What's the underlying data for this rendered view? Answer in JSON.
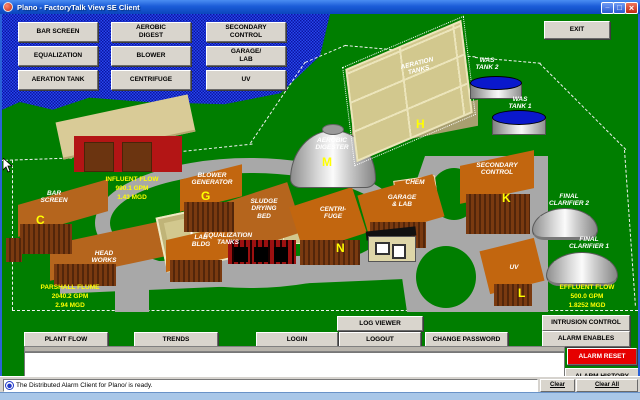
{
  "window": {
    "title": "Plano - FactoryTalk View SE Client"
  },
  "nav": {
    "buttons": [
      "BAR SCREEN",
      "AEROBIC\nDIGEST",
      "SECONDARY\nCONTROL",
      "EQUALIZATION",
      "BLOWER",
      "GARAGE/\nLAB",
      "AERATION TANK",
      "CENTRIFUGE",
      "UV"
    ],
    "exit": "EXIT"
  },
  "map": {
    "buildings": {
      "bar_screen": "BAR\nSCREEN",
      "head_works": "HEAD\nWORKS",
      "equalization": "EQUALIZATION\nTANKS",
      "blower_generator": "BLOWER\nGENERATOR",
      "lab_bldg": "LAB\nBLDG",
      "sludge": "SLUDGE\nDRYING\nBED",
      "centrifuge": "CENTRI-\nFUGE",
      "garage": "GARAGE\n& LAB",
      "chem": "CHEM",
      "secondary": "SECONDARY\nCONTROL",
      "uv": "UV",
      "aeration": "AERATION\nTANKS",
      "aerobic": "AEROBIC\nDIGESTER",
      "was2": "WAS\nTANK 2",
      "was1": "WAS\nTANK 1",
      "fc2": "FINAL\nCLARIFIER 2",
      "fc1": "FINAL\nCLARIFIER 1"
    },
    "markers": {
      "c": "C",
      "g": "G",
      "h": "H",
      "k": "K",
      "l": "L",
      "m": "M",
      "n": "N"
    },
    "flows": {
      "influent": "INFLUENT FLOW\n990.1 GPM\n1.43 MGD",
      "parshall": "PARSHALL FLUME\n2040.2 GPM\n2.94 MGD",
      "effluent": "EFFLUENT FLOW\n500.0 GPM\n1.8252 MGD"
    }
  },
  "toolbar": {
    "log_viewer": "LOG VIEWER",
    "intrusion_control": "INTRUSION CONTROL",
    "plant_flow": "PLANT FLOW",
    "trends": "TRENDS",
    "login": "LOGIN",
    "logout": "LOGOUT",
    "change_password": "CHANGE PASSWORD",
    "alarm_enables": "ALARM ENABLES",
    "alarm_reset": "ALARM RESET",
    "alarm_history": "ALARM HISTORY"
  },
  "status": {
    "message": "The Distributed Alarm Client for Plano/ is ready.",
    "clear": "Clear",
    "clear_all": "Clear All"
  },
  "colors": {
    "alarm-red": "#e60000",
    "alarm-yellow": "#ffff00",
    "grass-green": "#007e00",
    "water-blue": "#1a35e8",
    "titlebar-blue": "#1b5cd8"
  }
}
